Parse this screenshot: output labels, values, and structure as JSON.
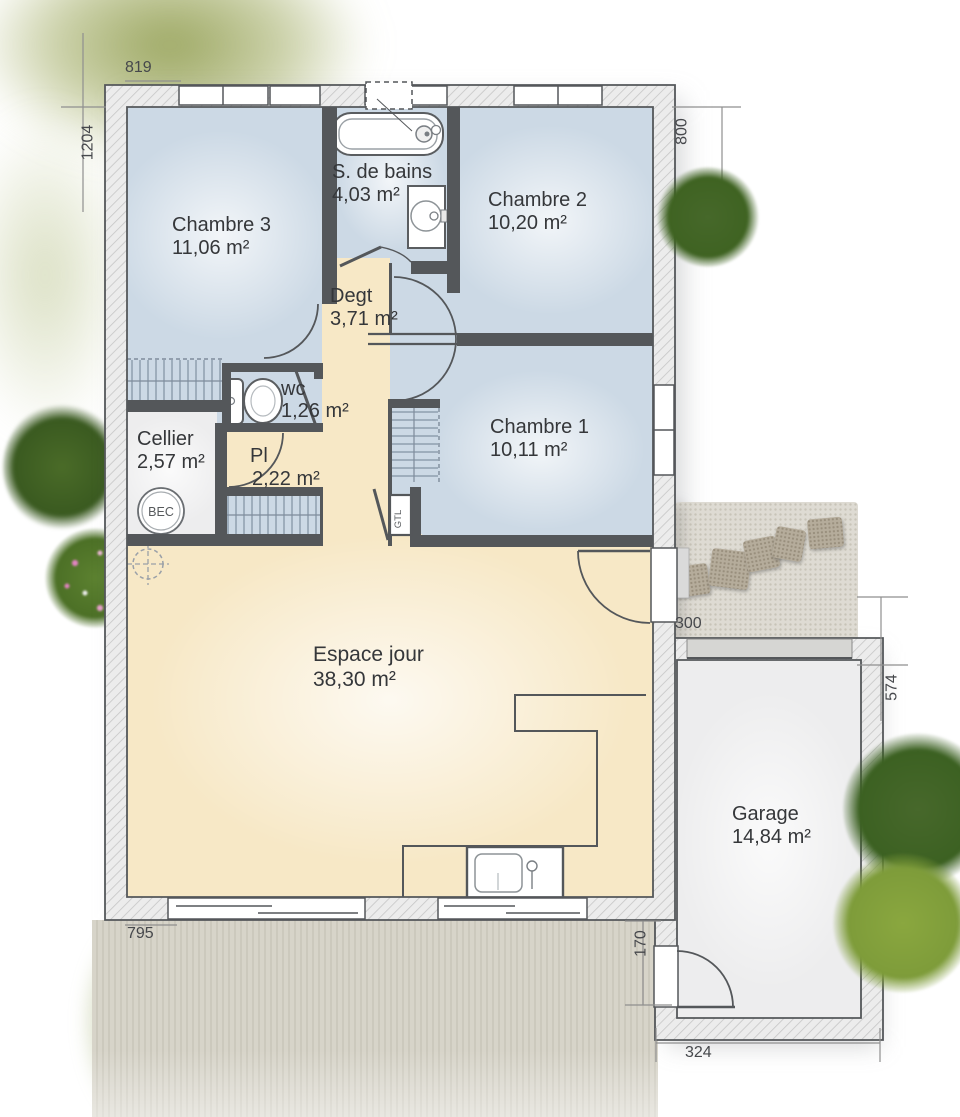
{
  "plan": {
    "rooms": {
      "chambre3": {
        "name": "Chambre 3",
        "area": "11,06 m²"
      },
      "sdb": {
        "name": "S. de bains",
        "area": "4,03 m²"
      },
      "chambre2": {
        "name": "Chambre 2",
        "area": "10,20 m²"
      },
      "degt": {
        "name": "Degt",
        "area": "3,71 m²"
      },
      "wc": {
        "name": "wc",
        "area": "1,26 m²"
      },
      "chambre1": {
        "name": "Chambre 1",
        "area": "10,11 m²"
      },
      "cellier": {
        "name": "Cellier",
        "area": "2,57 m²"
      },
      "pl": {
        "name": "Pl",
        "area": "2,22 m²"
      },
      "espace_jour": {
        "name": "Espace jour",
        "area": "38,30 m²"
      },
      "garage": {
        "name": "Garage",
        "area": "14,84 m²"
      }
    },
    "dimensions": {
      "top": "819",
      "left": "1204",
      "right_top": "800",
      "passage": "300",
      "garage_right": "574",
      "bottom": "795",
      "garage_door_side": "170",
      "garage_bottom": "324"
    },
    "equipment": {
      "water_heater": "BEC",
      "technical_duct": "GTL"
    },
    "colors": {
      "room_blue": "#ccd9e5",
      "living_beige": "#f7e8c6",
      "wall_dark": "#54575a",
      "utility_gray": "#ededee",
      "garden_green_dark": "#3f6322",
      "garden_green_light": "#7e9c3a"
    }
  }
}
